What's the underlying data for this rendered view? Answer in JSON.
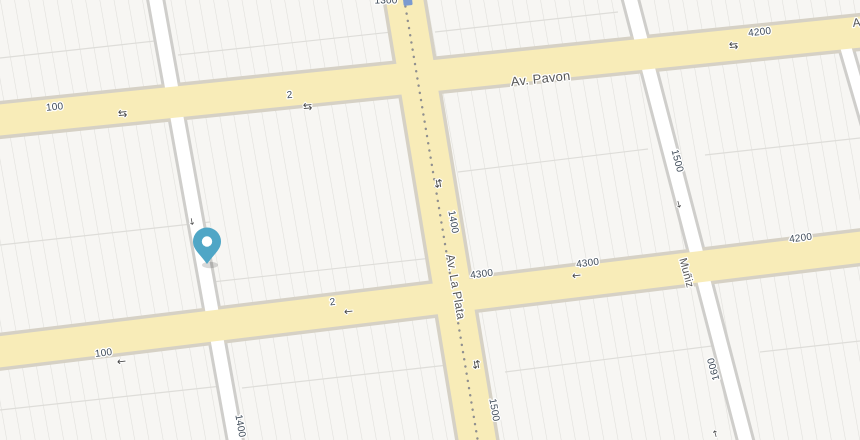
{
  "map": {
    "labels": {
      "pavon_name": "Av. Pavon",
      "pavon_block_100": "100",
      "pavon_block_2": "2",
      "pavon_block_4200": "4200",
      "pavon_edge_partial": "Av.",
      "lower_block_100": "100",
      "lower_block_2": "2",
      "lower_block_4300_west": "4300",
      "lower_block_4300_east": "4300",
      "lower_block_4200": "4200",
      "laplata_name": "Av. La Plata",
      "laplata_block_1300": "1300",
      "laplata_block_1400": "1400",
      "laplata_block_1500": "1500",
      "left_street_block_1400": "1400",
      "muniz_name": "Muñiz",
      "muniz_block_1500": "1500",
      "muniz_block_1600": "1600"
    },
    "icons": {
      "two_way_arrow": "⇆",
      "one_way_left": "←",
      "one_way_along": "→"
    },
    "colors": {
      "background": "#efeeec",
      "block_fill": "#f7f6f3",
      "parcel_line": "#e0dfdb",
      "street_casing": "#cfcecb",
      "avenue_casing": "#d6d1c5",
      "avenue_fill": "#f8ecb8",
      "street_fill": "#ffffff",
      "number_label": "#3f4b58",
      "name_label": "#595959",
      "transit_dot": "#8f8f8f",
      "pin_fill": "#4fa6c6",
      "pin_hole": "#ffffff",
      "pin_shadow": "#2e2e2e",
      "transit_badge": "#7b9ad0"
    },
    "marker": {
      "type": "location-pin",
      "color": "#4fa6c6"
    }
  }
}
